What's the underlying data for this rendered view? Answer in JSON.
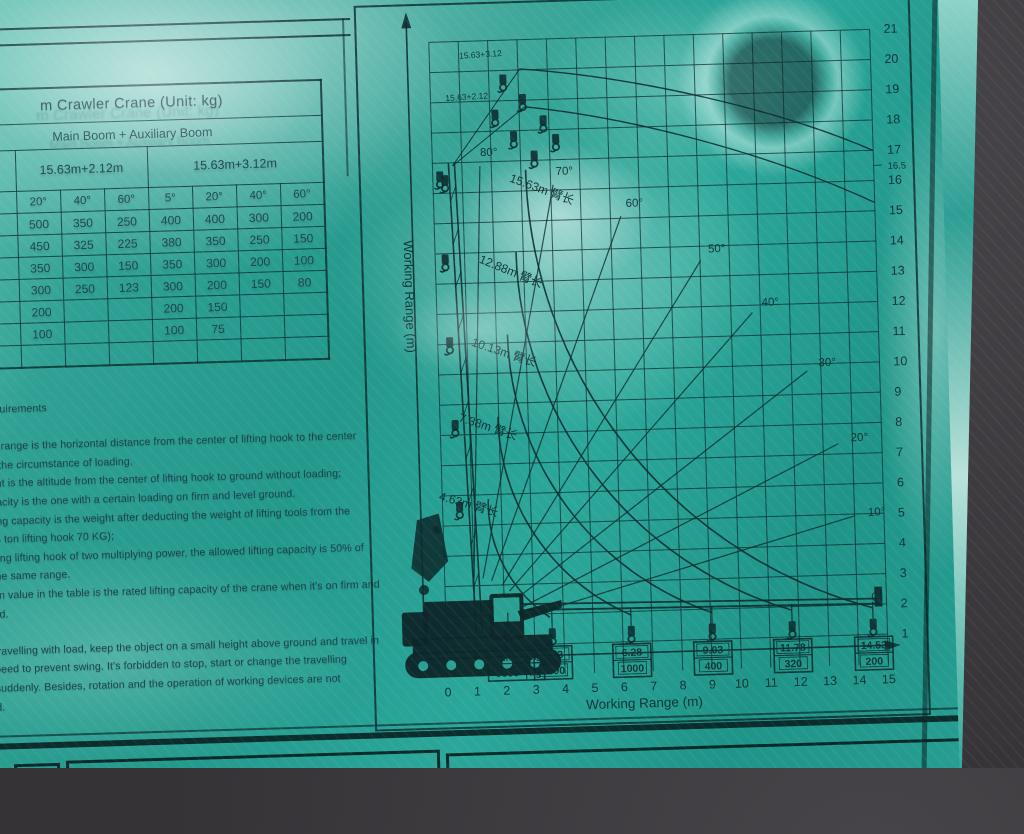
{
  "table": {
    "title": "m Crawler Crane (Unit: kg)",
    "header_group": "Main Boom + Auxiliary Boom",
    "config_left": "15.63m+2.12m",
    "config_right": "15.63m+3.12m",
    "angle_headers": [
      "",
      "20°",
      "40°",
      "60°",
      "5°",
      "20°",
      "40°",
      "60°"
    ],
    "rows": [
      [
        "0",
        "500",
        "350",
        "250",
        "400",
        "400",
        "300",
        "200"
      ],
      [
        "80",
        "450",
        "325",
        "225",
        "380",
        "350",
        "250",
        "150"
      ],
      [
        "50",
        "350",
        "300",
        "150",
        "350",
        "300",
        "200",
        "100"
      ],
      [
        "50",
        "300",
        "250",
        "123",
        "300",
        "200",
        "150",
        "80"
      ],
      [
        "250",
        "200",
        "",
        "",
        "200",
        "150",
        "",
        ""
      ],
      [
        "150",
        "100",
        "",
        "",
        "100",
        "75",
        "",
        ""
      ],
      [
        "50",
        "",
        "",
        "",
        "",
        "",
        "",
        ""
      ]
    ]
  },
  "notes": {
    "lines": [
      "equirements",
      "",
      "of range is the horizontal distance from the center of lifting hook to the center",
      "n the circumstance of loading.",
      "ght is the altitude from the center of lifting hook to ground without loading;",
      "pacity is the one with a certain loading on firm and level ground.",
      "ting capacity is the weight after deducting the weight of lifting tools from the",
      "(5 ton lifting hook 70 KG);",
      "sing lifting hook of two multiplying power, the allowed lifting capacity is 50% of",
      "the same range.",
      "en value in the table is the rated lifting capacity of the crane when it's on firm and",
      "nd.",
      "",
      "travelling with load, keep the object on a small height above ground and travel in",
      "peed to prevent swing. It's forbidden to stop, start or change the travelling",
      "suddenly. Besides, rotation and the operation of working devices are not",
      "d."
    ]
  },
  "chart_data": {
    "type": "line",
    "title": "",
    "xlabel": "Working Range (m)",
    "ylabel": "Working Range (m)",
    "xlim": [
      0,
      15
    ],
    "ylim": [
      0,
      21
    ],
    "x_ticks": [
      0,
      1,
      2,
      3,
      4,
      5,
      6,
      7,
      8,
      9,
      10,
      11,
      12,
      13,
      14,
      15
    ],
    "y_ticks": [
      1,
      2,
      3,
      4,
      5,
      6,
      7,
      8,
      9,
      10,
      11,
      12,
      13,
      14,
      15,
      16,
      16.5,
      17,
      18,
      19,
      20,
      21
    ],
    "grid": true,
    "angle_lines_deg": [
      80,
      70,
      60,
      50,
      40,
      30,
      20,
      10,
      0
    ],
    "boom_curves": [
      {
        "label": "4.63m 臂长",
        "boom_m": 4.63,
        "max_radius_m": 3.53,
        "capacity_kg": 2300
      },
      {
        "label": "7.38m 臂长",
        "boom_m": 7.38,
        "max_radius_m": 6.28,
        "capacity_kg": 1000
      },
      {
        "label": "10.13m 臂长",
        "boom_m": 10.13,
        "max_radius_m": 9.03,
        "capacity_kg": 400
      },
      {
        "label": "12.88m 臂长",
        "boom_m": 12.88,
        "max_radius_m": 11.78,
        "capacity_kg": 320
      },
      {
        "label": "15.63m 臂长",
        "boom_m": 15.63,
        "max_radius_m": 14.53,
        "capacity_kg": 200
      }
    ],
    "jib_config_labels": [
      "15.63+2.12",
      "15.63+3.12"
    ],
    "min_radius_box": {
      "radius": "2.1",
      "radius_unit": "m",
      "capacity": "5000",
      "capacity_unit": "kg"
    },
    "radius_capacity_boxes": [
      {
        "radius": "3.53",
        "capacity": "2300"
      },
      {
        "radius": "6.28",
        "capacity": "1000"
      },
      {
        "radius": "9.03",
        "capacity": "400"
      },
      {
        "radius": "11.78",
        "capacity": "320"
      },
      {
        "radius": "14.53",
        "capacity": "200"
      }
    ]
  },
  "colors": {
    "panel_teal": "#27a093",
    "ink": "#102e32",
    "background_gray": "#3a383b",
    "glare_white": "#f0fbf7"
  }
}
